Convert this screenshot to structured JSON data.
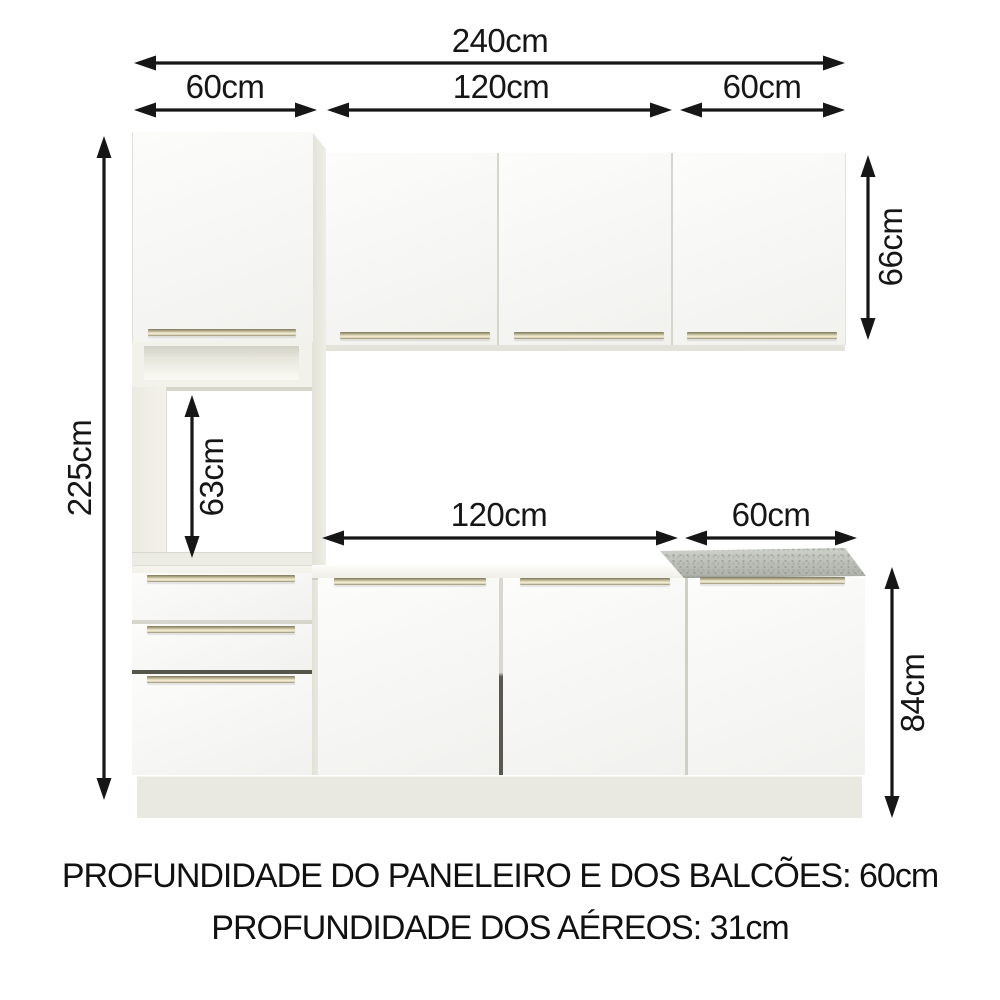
{
  "diagram": {
    "dimensions": {
      "total_width": "240cm",
      "tower_width": "60cm",
      "upper_middle_width": "120cm",
      "upper_right_width": "60cm",
      "total_height": "225cm",
      "aereo_height": "66cm",
      "oven_space_height": "63cm",
      "base_middle_width": "120cm",
      "base_right_width": "60cm",
      "base_height": "84cm"
    },
    "footer": {
      "line1": "PROFUNDIDADE DO PANELEIRO E DOS BALCÕES: 60cm",
      "line2": "PROFUNDIDADE DOS AÉREOS: 31cm"
    },
    "colors": {
      "arrow": "#161616",
      "door_face": "#f6f6f4",
      "handle": "#cdc6a6",
      "granite_top": "#c3c7bf",
      "plinth": "#e9e9e2",
      "background": "#ffffff"
    }
  }
}
